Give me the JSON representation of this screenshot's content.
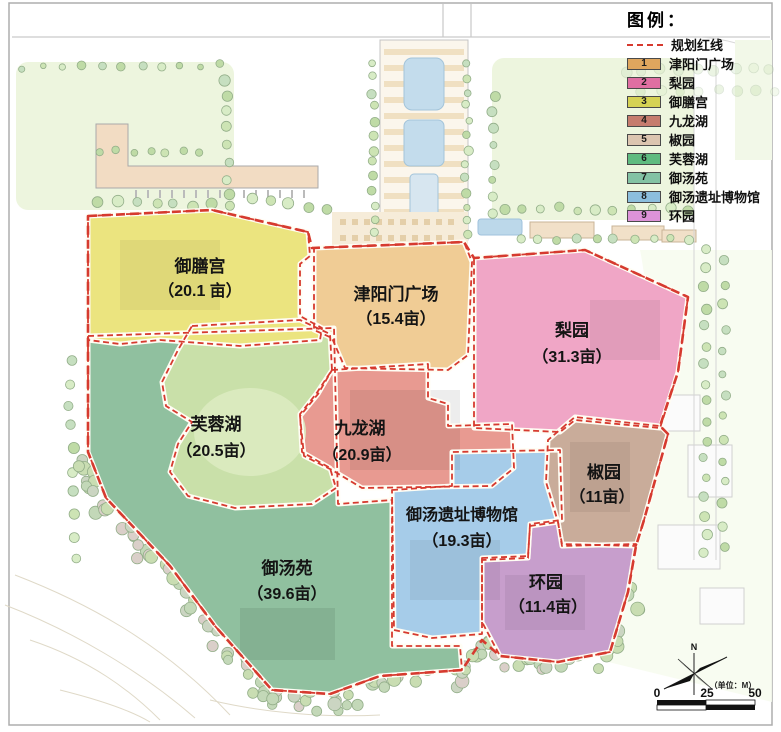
{
  "legend": {
    "title": "图例：",
    "red_line_label": "规划红线",
    "items": [
      {
        "num": "1",
        "label": "津阳门广场",
        "color": "#DFA65E"
      },
      {
        "num": "2",
        "label": "梨园",
        "color": "#DF6FA2"
      },
      {
        "num": "3",
        "label": "御膳宫",
        "color": "#D6D254"
      },
      {
        "num": "4",
        "label": "九龙湖",
        "color": "#C67C6E"
      },
      {
        "num": "5",
        "label": "椒园",
        "color": "#DCC5B0"
      },
      {
        "num": "6",
        "label": "芙蓉湖",
        "color": "#5FBB80"
      },
      {
        "num": "7",
        "label": "御汤苑",
        "color": "#83C2A4"
      },
      {
        "num": "8",
        "label": "御汤遗址博物馆",
        "color": "#8CBEDD"
      },
      {
        "num": "9",
        "label": "环园",
        "color": "#DD92D8"
      }
    ]
  },
  "zones": [
    {
      "id": "yushangong",
      "name": "御膳宫",
      "area": "（20.1 亩）",
      "color": "#EBE47F"
    },
    {
      "id": "jinyangmen",
      "name": "津阳门广场",
      "area": "（15.4亩）",
      "color": "#F0CC95"
    },
    {
      "id": "liyuan",
      "name": "梨园",
      "area": "（31.3亩）",
      "color": "#F0A6C6"
    },
    {
      "id": "furonghu",
      "name": "芙蓉湖",
      "area": "（20.5亩）",
      "color": "#C9E0A9"
    },
    {
      "id": "jiulonghu",
      "name": "九龙湖",
      "area": "（20.9亩）",
      "color": "#E89A91"
    },
    {
      "id": "jiaoyuan",
      "name": "椒园",
      "area": "（11亩）",
      "color": "#C9AC9A"
    },
    {
      "id": "museum",
      "name": "御汤遗址博物馆",
      "area": "（19.3亩）",
      "color": "#A6CCE9"
    },
    {
      "id": "huanyuan",
      "name": "环园",
      "area": "（11.4亩）",
      "color": "#C79ECC"
    },
    {
      "id": "yutangyuan",
      "name": "御汤苑",
      "area": "（39.6亩）",
      "color": "#90C09F"
    }
  ],
  "compass": {
    "north_label": "N",
    "unit_label": "（单位：M）"
  },
  "scale_bar": {
    "ticks": [
      "0",
      "25",
      "50"
    ]
  },
  "boundary_color": "#D63A2F"
}
